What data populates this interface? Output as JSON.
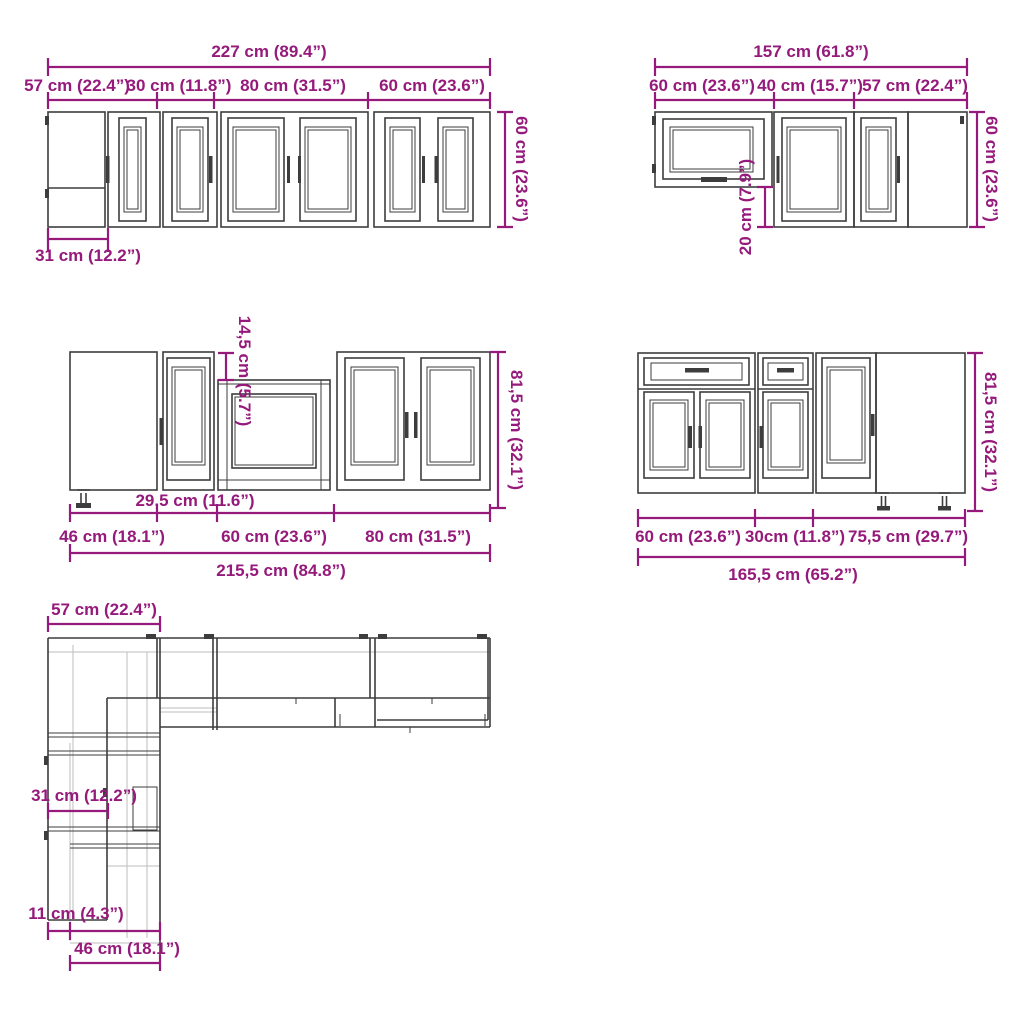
{
  "diagram": {
    "title": "kitchen-cabinet-set-dimension-diagram",
    "colors": {
      "accent": "#951A7B",
      "line": "#3D3D3D",
      "line_light": "#BDBDBD",
      "background": "#FFFFFF"
    },
    "views": {
      "wall_run": {
        "overall": "227 cm (89.4”)",
        "seg_corner": "57 cm (22.4”)",
        "seg_cab30": "30 cm (11.8”)",
        "seg_cab80": "80 cm (31.5”)",
        "seg_cab60": "60 cm (23.6”)",
        "height": "60 cm (23.6”)",
        "corner_depth": "31 cm (12.2”)"
      },
      "wall_corner": {
        "overall": "157 cm (61.8”)",
        "seg_cab60": "60 cm (23.6”)",
        "seg_cab40": "40 cm (15.7”)",
        "seg_corner": "57 cm (22.4”)",
        "height": "60 cm (23.6”)",
        "flip_clearance": "20 cm (7.9”)"
      },
      "base_run": {
        "recess": "14,5 cm (5.7”)",
        "height": "81,5 cm (32.1”)",
        "seg_cab295": "29,5 cm (11.6”)",
        "seg_corner": "46 cm (18.1”)",
        "seg_cab60": "60 cm (23.6”)",
        "seg_cab80": "80 cm (31.5”)",
        "overall": "215,5 cm (84.8”)"
      },
      "base_corner": {
        "height": "81,5 cm (32.1”)",
        "seg_cab60": "60 cm (23.6”)",
        "seg_cab30": "30cm (11.8”)",
        "seg_corner": "75,5 cm (29.7”)",
        "overall": "165,5 cm (65.2”)"
      },
      "plan": {
        "corner_width": "57 cm (22.4”)",
        "wall_depth": "31 cm (12.2”)",
        "base_offset": "11 cm (4.3”)",
        "base_depth": "46 cm (18.1”)"
      }
    }
  }
}
